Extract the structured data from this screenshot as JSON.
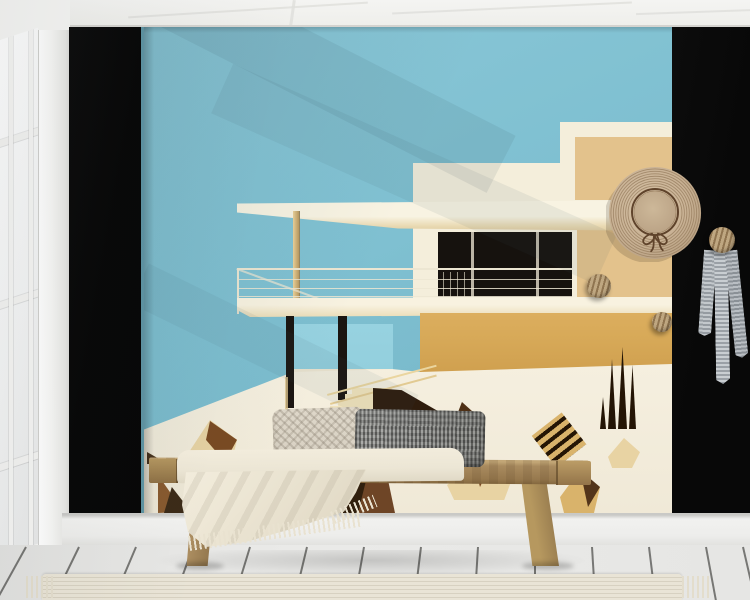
{
  "scene": {
    "label": "Interior mockup: abstract modernist-house wall mural in a bright room with wooden bench, cushions, throw blanket, straw hat and scarf on wall knobs"
  },
  "artwork": {
    "label": "Abstract mid-century modern house wall mural",
    "elements": [
      "blue sky",
      "white modernist villa",
      "flat canopy roof",
      "balcony wire railing",
      "dark glazing band",
      "golden lower wall",
      "piloti columns",
      "garden steps",
      "snowy foreground",
      "angular rocks",
      "cypress spikes"
    ]
  },
  "room": {
    "window": "white paned window",
    "ceiling": "white beamed ceiling",
    "side_panels": "black wall panels flanking the mural",
    "baseboard": "white baseboard",
    "floor": "whitewashed wood plank floor",
    "rug": "ribbed natural runner rug"
  },
  "furnishings": {
    "bench": "rustic wooden bench",
    "pillow_left": "light woven lumbar cushion",
    "pillow_right": "charcoal herringbone lumbar cushion",
    "blanket": "cream fringed throw blanket"
  },
  "wall_decor": {
    "hat": "straw sun hat with brown ribbon bow",
    "hooks": "round wooden wall knobs",
    "scarf": "grey striped scarf hanging from wooden knob"
  },
  "palette": {
    "sky_blue": "#7fc0d1",
    "sky_blue_light": "#93cfdd",
    "house_cream": "#f4eedb",
    "canopy_shade": "#e9d9b2",
    "tan_panel": "#e3c28c",
    "gold_wall": "#d7a958",
    "window_black": "#16120e",
    "snow_white": "#f5efdf",
    "dark_brown": "#2f1d0d",
    "mid_brown": "#7a4a22",
    "rock_brown": "#8a5a2e",
    "rock_tan": "#e8d3a3",
    "spike_brown": "#241505",
    "panel_black": "#080808",
    "ceiling_white": "#f4f4f2",
    "wall_white": "#f6f6f4",
    "floor_white": "#eaeae8",
    "baseboard_white": "#f1f1ef",
    "rug_cream": "#e9e4d6",
    "rug_rib": "#d7d1c1",
    "bench_wood": "#a98b5f",
    "bench_wood_dark": "#8a6f47",
    "pillow_light": "#d7d0c2",
    "pillow_dark": "#8b8c89",
    "blanket_cream": "#ece6d5",
    "hat_straw": "#c9b295",
    "hat_ring": "#967c5d",
    "hat_ribbon": "#5f432b",
    "knob_wood": "#bfa781",
    "knob_stripe": "#8f7450",
    "scarf_grey": "#9aa0a6",
    "scarf_light": "#c9ced2"
  }
}
